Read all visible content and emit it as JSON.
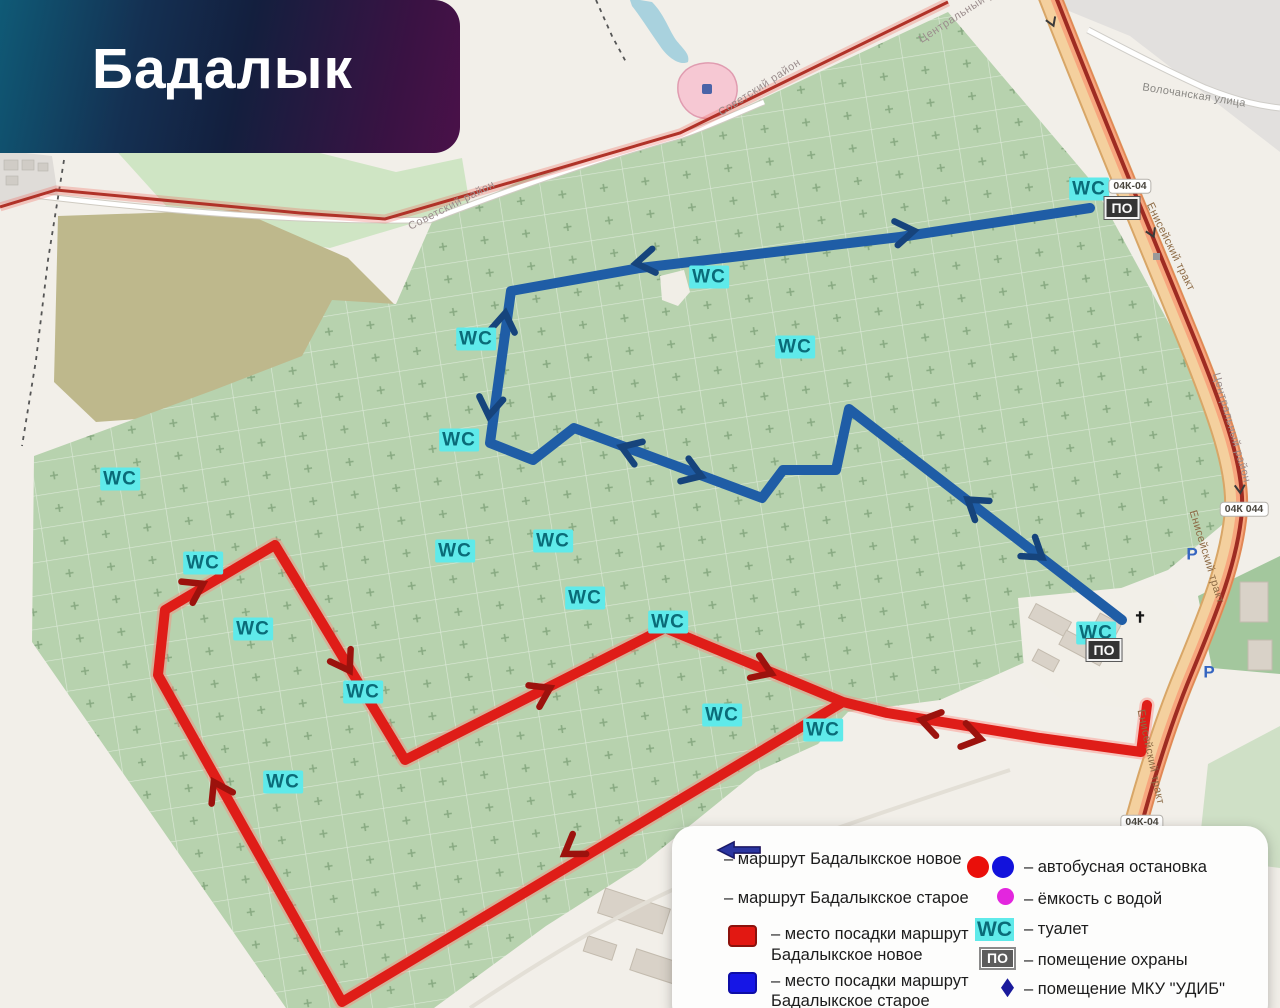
{
  "banner": {
    "title": "Бадалык"
  },
  "map": {
    "labels": {
      "wc": "WC",
      "po": "ПО",
      "parking": "Р",
      "cross": "✝"
    },
    "roads": {
      "yeniseysky": "Енисейский тракт",
      "volochanskaya": "Волочанская улица",
      "ref": "04К 044",
      "ref_short": "04К-04"
    },
    "districts": {
      "sovetsky": "Советский район",
      "central": "Центральный район"
    }
  },
  "legend": {
    "items": [
      {
        "marker": "arrow-red",
        "label": "– маршрут Бадалыкское новое"
      },
      {
        "marker": "arrow-blue",
        "label": "– маршрут Бадалыкское старое"
      },
      {
        "marker": "square-red",
        "label": "– место посадки маршрут Бадалыкское новое"
      },
      {
        "marker": "square-blue",
        "label": "– место посадки маршрут Бадалыкское старое"
      },
      {
        "marker": "circles-red-blue",
        "label": "– автобусная остановка"
      },
      {
        "marker": "circle-magenta",
        "label": "– ёмкость с водой"
      },
      {
        "marker": "wc",
        "symbol": "WC",
        "label": "– туалет"
      },
      {
        "marker": "po",
        "symbol": "ПО",
        "label": "– помещение охраны"
      },
      {
        "marker": "diamond-navy",
        "label": "– помещение МКУ \"УДИБ\""
      }
    ]
  },
  "colors": {
    "route_new": "#df1d18",
    "route_old": "#1f5da6",
    "cemetery": "#b7d2ae",
    "road_fill": "#f4d09e",
    "district_boundary": "#b03228",
    "wc_bg": "#5feaea",
    "wc_text": "#0a6b78"
  }
}
